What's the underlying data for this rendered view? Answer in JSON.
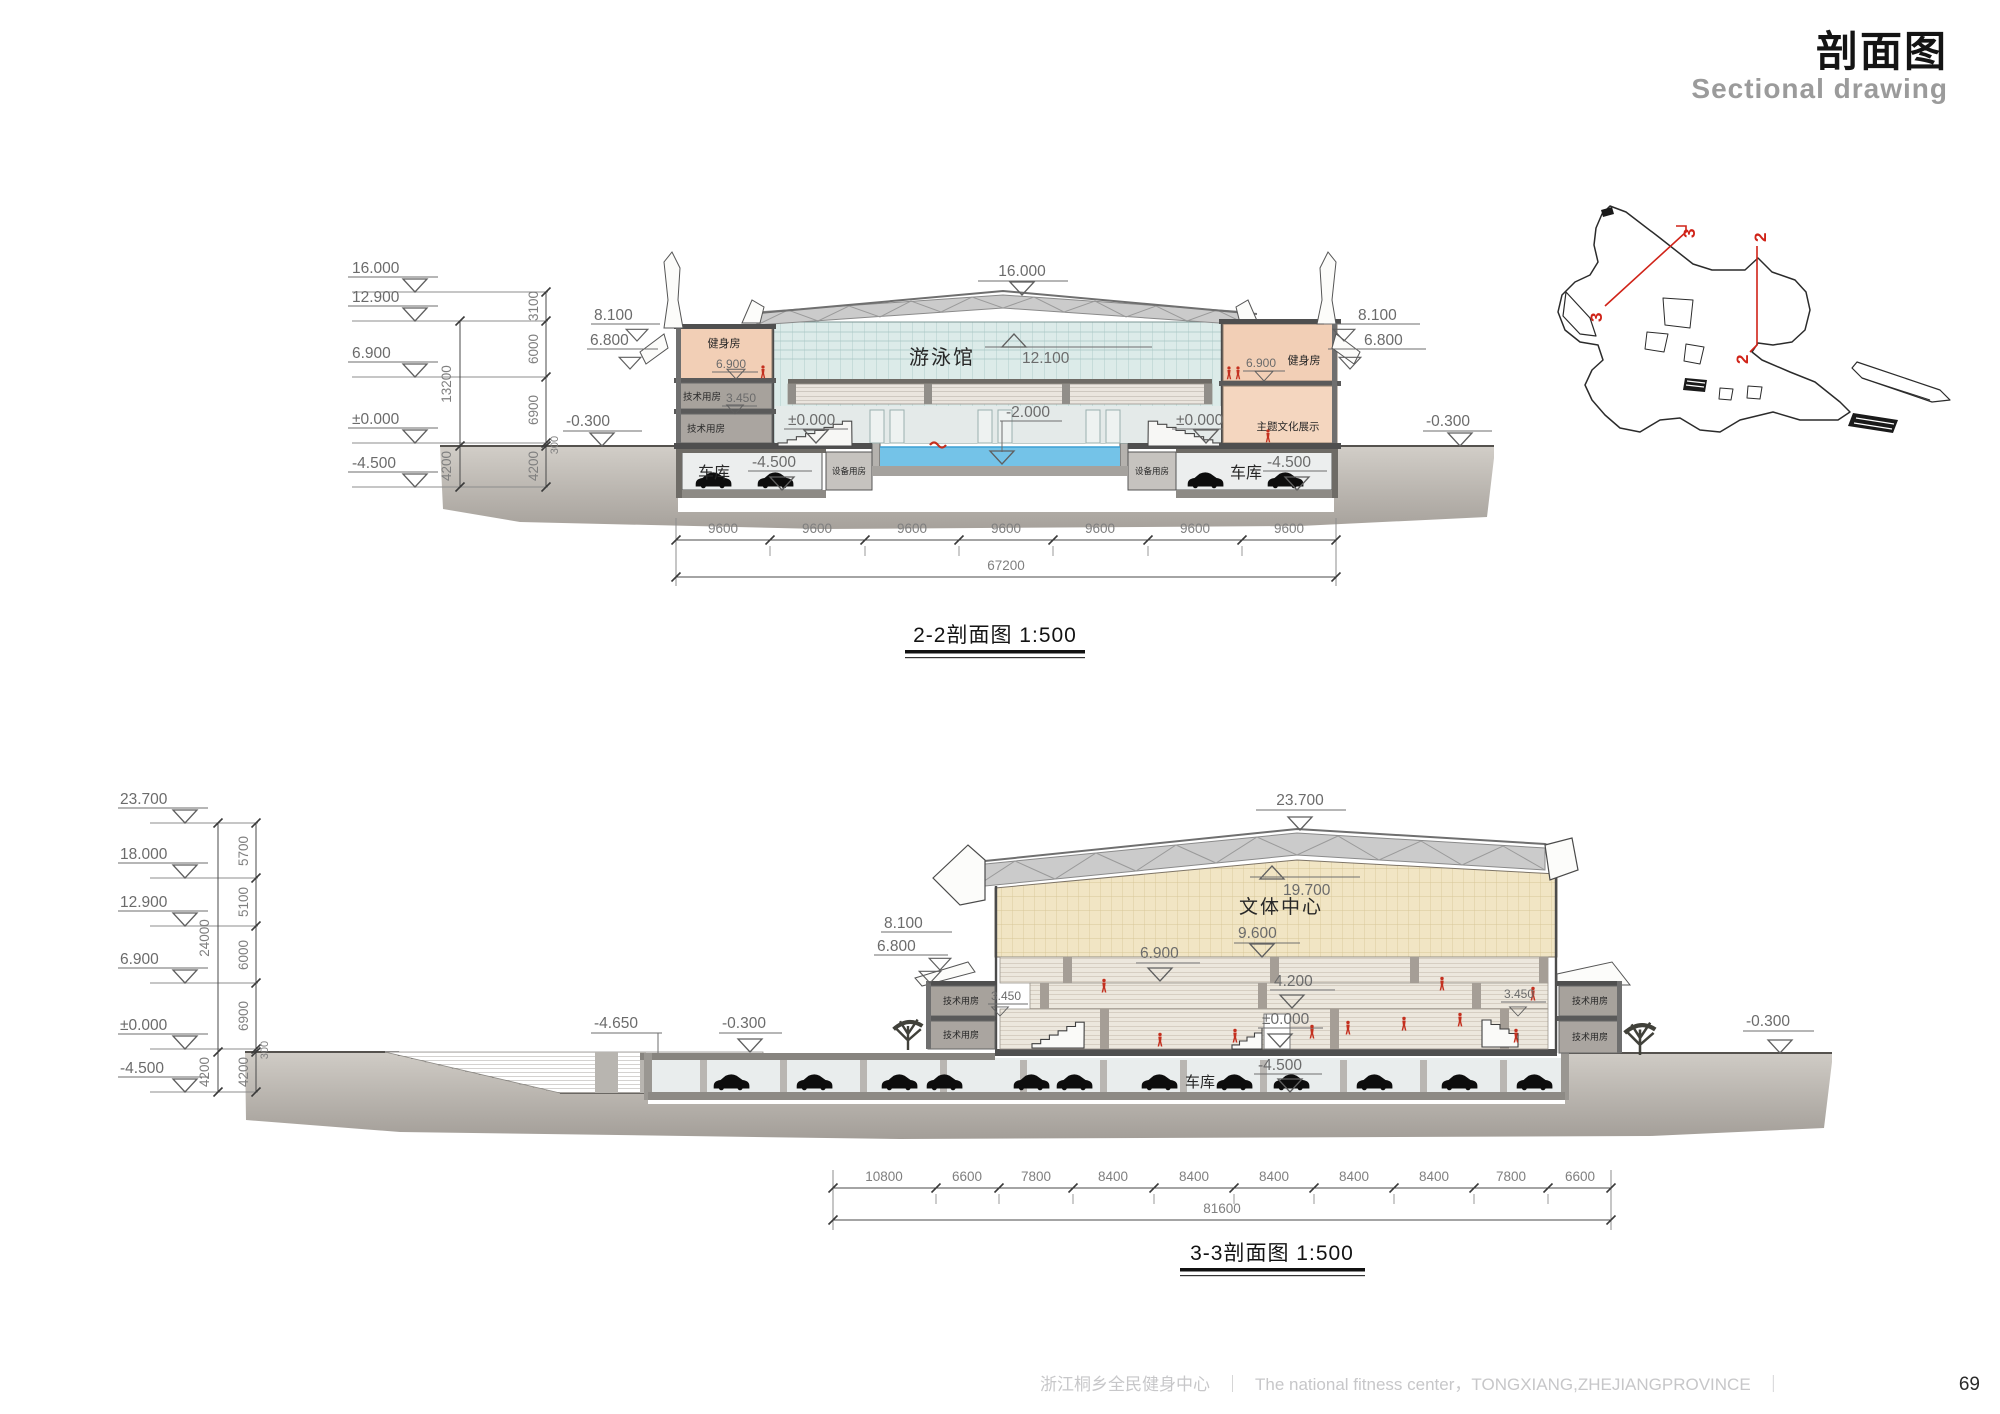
{
  "title": {
    "cn": "剖面图",
    "en": "Sectional drawing"
  },
  "footer": {
    "project_cn": "浙江桐乡全民健身中心",
    "divider": "｜",
    "project_en": "The national fitness center，TONGXIANG,ZHEJIANGPROVINCE",
    "page": "69"
  },
  "keyplan": {
    "sec2": "2",
    "sec3": "3"
  },
  "colors": {
    "salmon": "#f2cfb6",
    "glass": "#dcebe9",
    "water": "#74c3e8",
    "tan_wall": "#f1e5c4",
    "gray_room": "#a7a29c",
    "ground": "#aaa5a0",
    "truss": "#cbcbcb",
    "red_figure": "#c4301f",
    "section_line_red": "#d02318"
  },
  "section22": {
    "caption": "2-2剖面图 1:500",
    "levels": [
      "16.000",
      "12.900",
      "6.900",
      "±0.000",
      "-4.500"
    ],
    "chainA": [
      "13200",
      "4200"
    ],
    "chainB": [
      "3100",
      "6000",
      "6900",
      "300",
      "4200"
    ],
    "marks": {
      "e16": "16.000",
      "e121": "12.100",
      "e81": "8.100",
      "e68": "6.800",
      "e69": "6.900",
      "e345": "3.450",
      "e0": "±0.000",
      "e2": "-2.000",
      "e45": "-4.500",
      "e03": "-0.300"
    },
    "rooms": {
      "pool": "游泳馆",
      "gym": "健身房",
      "tech": "技术用房",
      "equip": "设备用房",
      "garage": "车库",
      "culture": "主题文化展示"
    },
    "dim": "9600",
    "total": "67200"
  },
  "section33": {
    "caption": "3-3剖面图 1:500",
    "levels": [
      "23.700",
      "18.000",
      "12.900",
      "6.900",
      "±0.000",
      "-4.500"
    ],
    "chainA": [
      "24000",
      "4200"
    ],
    "chainB": [
      "5700",
      "5100",
      "6000",
      "6900",
      "300",
      "4200"
    ],
    "marks": {
      "e237": "23.700",
      "e197": "19.700",
      "e96": "9.600",
      "e69": "6.900",
      "e42": "4.200",
      "e0": "±0.000",
      "e45": "-4.500",
      "e345": "3.450",
      "e81": "8.100",
      "e68": "6.800",
      "e465": "-4.650",
      "e03": "-0.300"
    },
    "rooms": {
      "center": "文体中心",
      "tech": "技术用房",
      "garage": "车库"
    },
    "dims": [
      "10800",
      "6600",
      "7800",
      "8400",
      "8400",
      "8400",
      "8400",
      "8400",
      "7800",
      "6600"
    ],
    "total": "81600"
  }
}
